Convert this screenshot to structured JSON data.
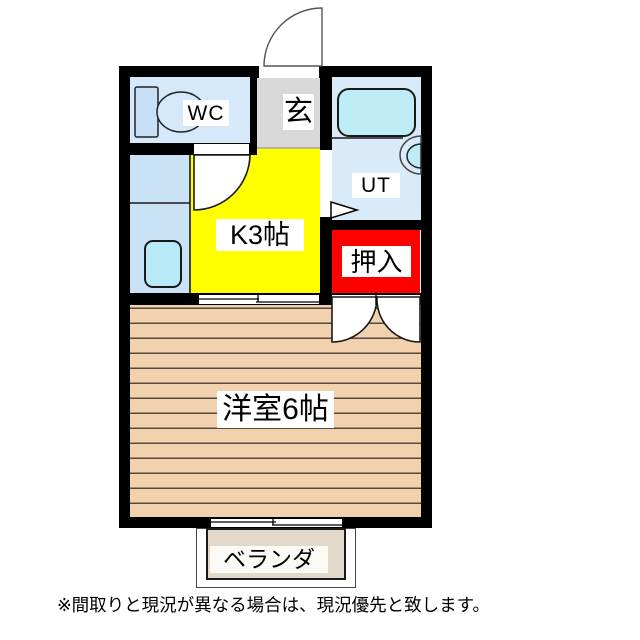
{
  "floor_plan": {
    "labels": {
      "wc": "WC",
      "entrance": "玄",
      "utility": "UT",
      "kitchen": "K3帖",
      "closet": "押入",
      "main_room": "洋室6帖",
      "balcony": "ベランダ"
    },
    "disclaimer": "※間取りと現況が異なる場合は、現況優先と致します。",
    "colors": {
      "wall": "#000000",
      "kitchen_floor": "#FFFF00",
      "closet_fill": "#FF0000",
      "wc_floor": "#D6E9FB",
      "counter_floor": "#C9E2F6",
      "utility_floor": "#D9EAF9",
      "entrance_floor": "#D9D9D9",
      "main_room_floor": "#F2D1AE",
      "main_room_line": "#57493B",
      "bathtub_fill": "#BFEDF7",
      "sink_fill": "#B7EAF6",
      "balcony_fill": "#E2D9CB"
    }
  }
}
